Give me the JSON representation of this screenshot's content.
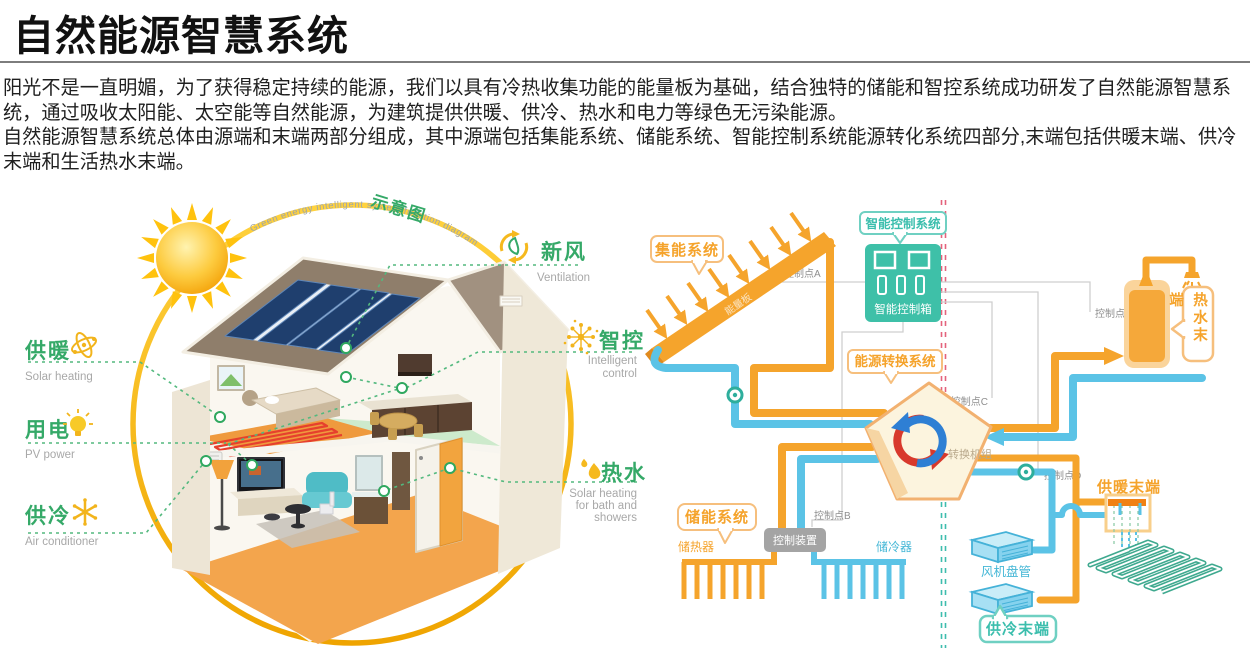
{
  "header": {
    "title": "自然能源智慧系统"
  },
  "intro": {
    "p1": "阳光不是一直明媚，为了获得稳定持续的能源，我们以具有冷热收集功能的能量板为基础，结合独特的储能和智控系统成功研发了自然能源智慧系统，通过吸收太阳能、太空能等自然能源，为建筑提供供暖、供冷、热水和电力等绿色无污染能源。",
    "p2": "自然能源智慧系统总体由源端和末端两部分组成，其中源端包括集能系统、储能系统、智能控制系统能源转化系统四部分,末端包括供暖末端、供冷末端和生活热水末端。"
  },
  "house_diagram": {
    "schematic_label": "示意图",
    "arc_text": "Green energy intelligent system function diagram",
    "heating_label": "供暖",
    "heating_sub": "Solar heating",
    "power_label": "用电",
    "power_sub": "PV power",
    "cooling_label": "供冷",
    "cooling_sub": "Air conditioner",
    "ventilation_label": "新风",
    "ventilation_sub": "Ventilation",
    "smart_label": "智控",
    "smart_sub1": "Intelligent",
    "smart_sub2": "control",
    "hotwater_label": "热水",
    "hotwater_sub1": "Solar heating",
    "hotwater_sub2": "for bath and",
    "hotwater_sub3": "showers"
  },
  "system_diagram": {
    "collection_system": "集能系统",
    "energy_panel": "能量板",
    "smart_control_system": "智能控制系统",
    "smart_control_box": "智能控制箱",
    "conversion_system": "能源转换系统",
    "conversion_unit": "转换机组",
    "storage_system": "储能系统",
    "heat_storage": "储热器",
    "control_device": "控制装置",
    "cold_storage": "储冷器",
    "fan_coil": "风机盘管",
    "cooling_terminal": "供冷末端",
    "heating_terminal": "供暖末端",
    "hot_water_terminal": "热水末端",
    "cp_a": "控制点A",
    "cp_b": "控制点B",
    "cp_c": "控制点C",
    "cp_d": "控制点D",
    "cp_e": "控制点E"
  },
  "colors": {
    "pipe_orange": "#F5A42C",
    "pipe_blue": "#5BC3E6",
    "box_teal": "#3EC0A8",
    "label_green": "#35A968",
    "icon_yellow": "#F2B41C",
    "sub_gray": "#A8A8A8",
    "recycle_red": "#D8392C",
    "recycle_blue": "#2E7FD4",
    "divider_red": "#E4637C",
    "divider_teal": "#3EBDAE"
  }
}
